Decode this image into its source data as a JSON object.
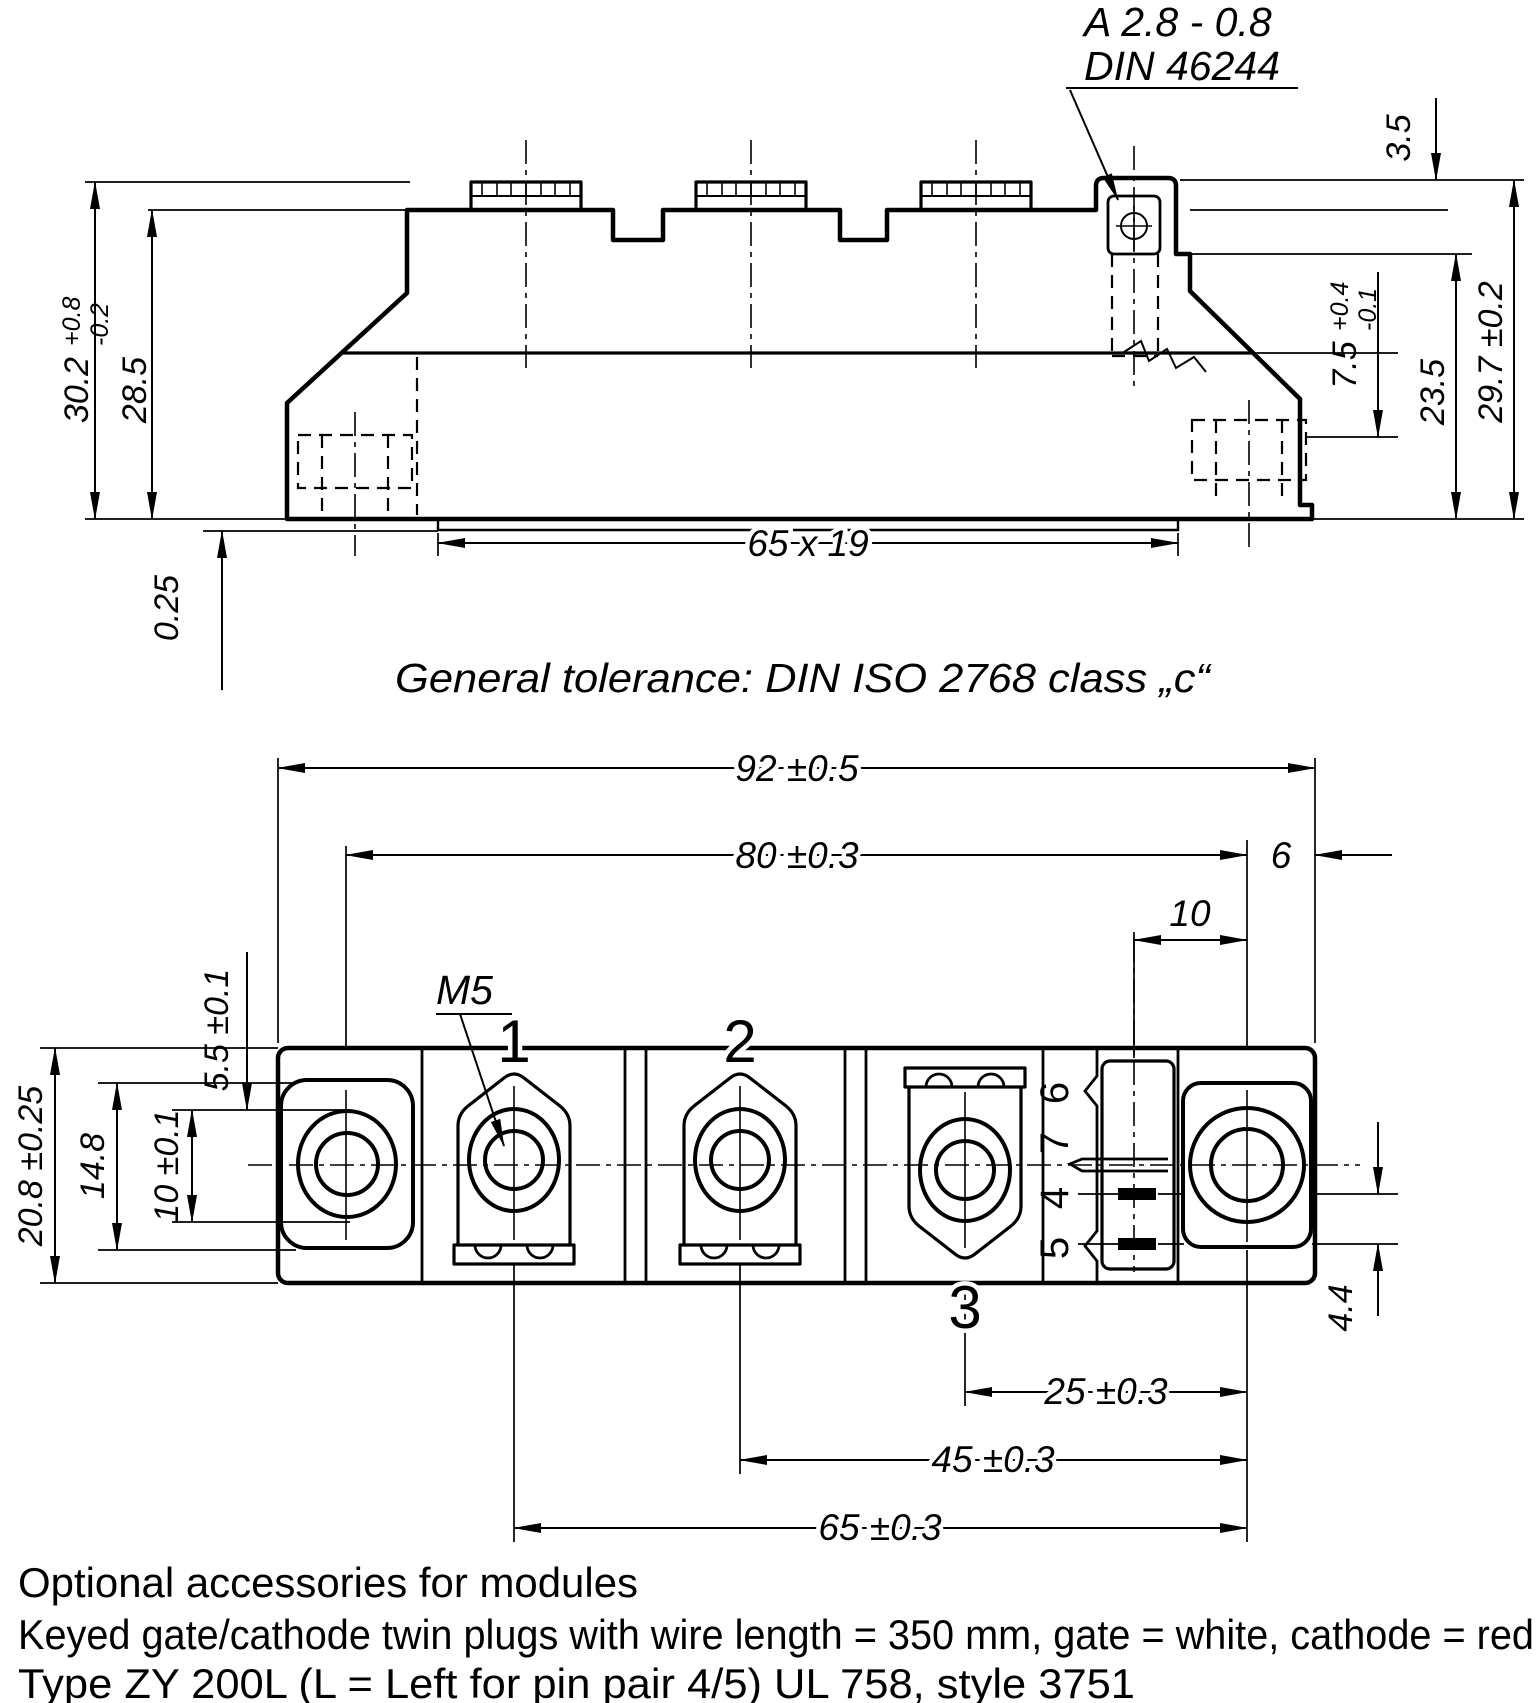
{
  "side_view": {
    "plug_note_line1": "A 2.8 - 0.8",
    "plug_note_line2": "DIN 46244",
    "dim_3_5": "3.5",
    "dim_30_2": {
      "value": "30.2",
      "tol_plus": "+0.8",
      "tol_minus": "-0.2"
    },
    "dim_28_5": "28.5",
    "dim_7_5": {
      "value": "7.5",
      "tol_plus": "+0.4",
      "tol_minus": "-0.1"
    },
    "dim_23_5": "23.5",
    "dim_29_7": "29.7 ±0.2",
    "dim_0_25": "0.25",
    "dim_baseplate": "65 x 19",
    "tolerance_note": "General tolerance: DIN ISO 2768 class „c“"
  },
  "top_view": {
    "dim_92": "92 ±0.5",
    "dim_80": "80 ±0.3",
    "dim_6": "6",
    "dim_10": "10",
    "thread_label": "M5",
    "dim_5_5": "5.5 ±0.1",
    "dim_14_8": "14.8",
    "dim_10_hole": "10 ±0.1",
    "dim_20_8": "20.8 ±0.25",
    "terminal_1": "1",
    "terminal_2": "2",
    "terminal_3": "3",
    "pin_6": "6",
    "pin_7": "7",
    "pin_4": "4",
    "pin_5": "5",
    "dim_25": "25 ±0.3",
    "dim_45": "45 ±0.3",
    "dim_65": "65 ±0.3",
    "dim_4_4": "4.4"
  },
  "footer": {
    "line1": "Optional accessories for modules",
    "line2": "Keyed gate/cathode twin plugs with wire length = 350 mm, gate = white, cathode = red",
    "line3": "Type ZY 200L  (L = Left for pin pair 4/5)  UL 758, style 3751"
  },
  "colors": {
    "ink": "#000000",
    "paper": "#ffffff"
  }
}
